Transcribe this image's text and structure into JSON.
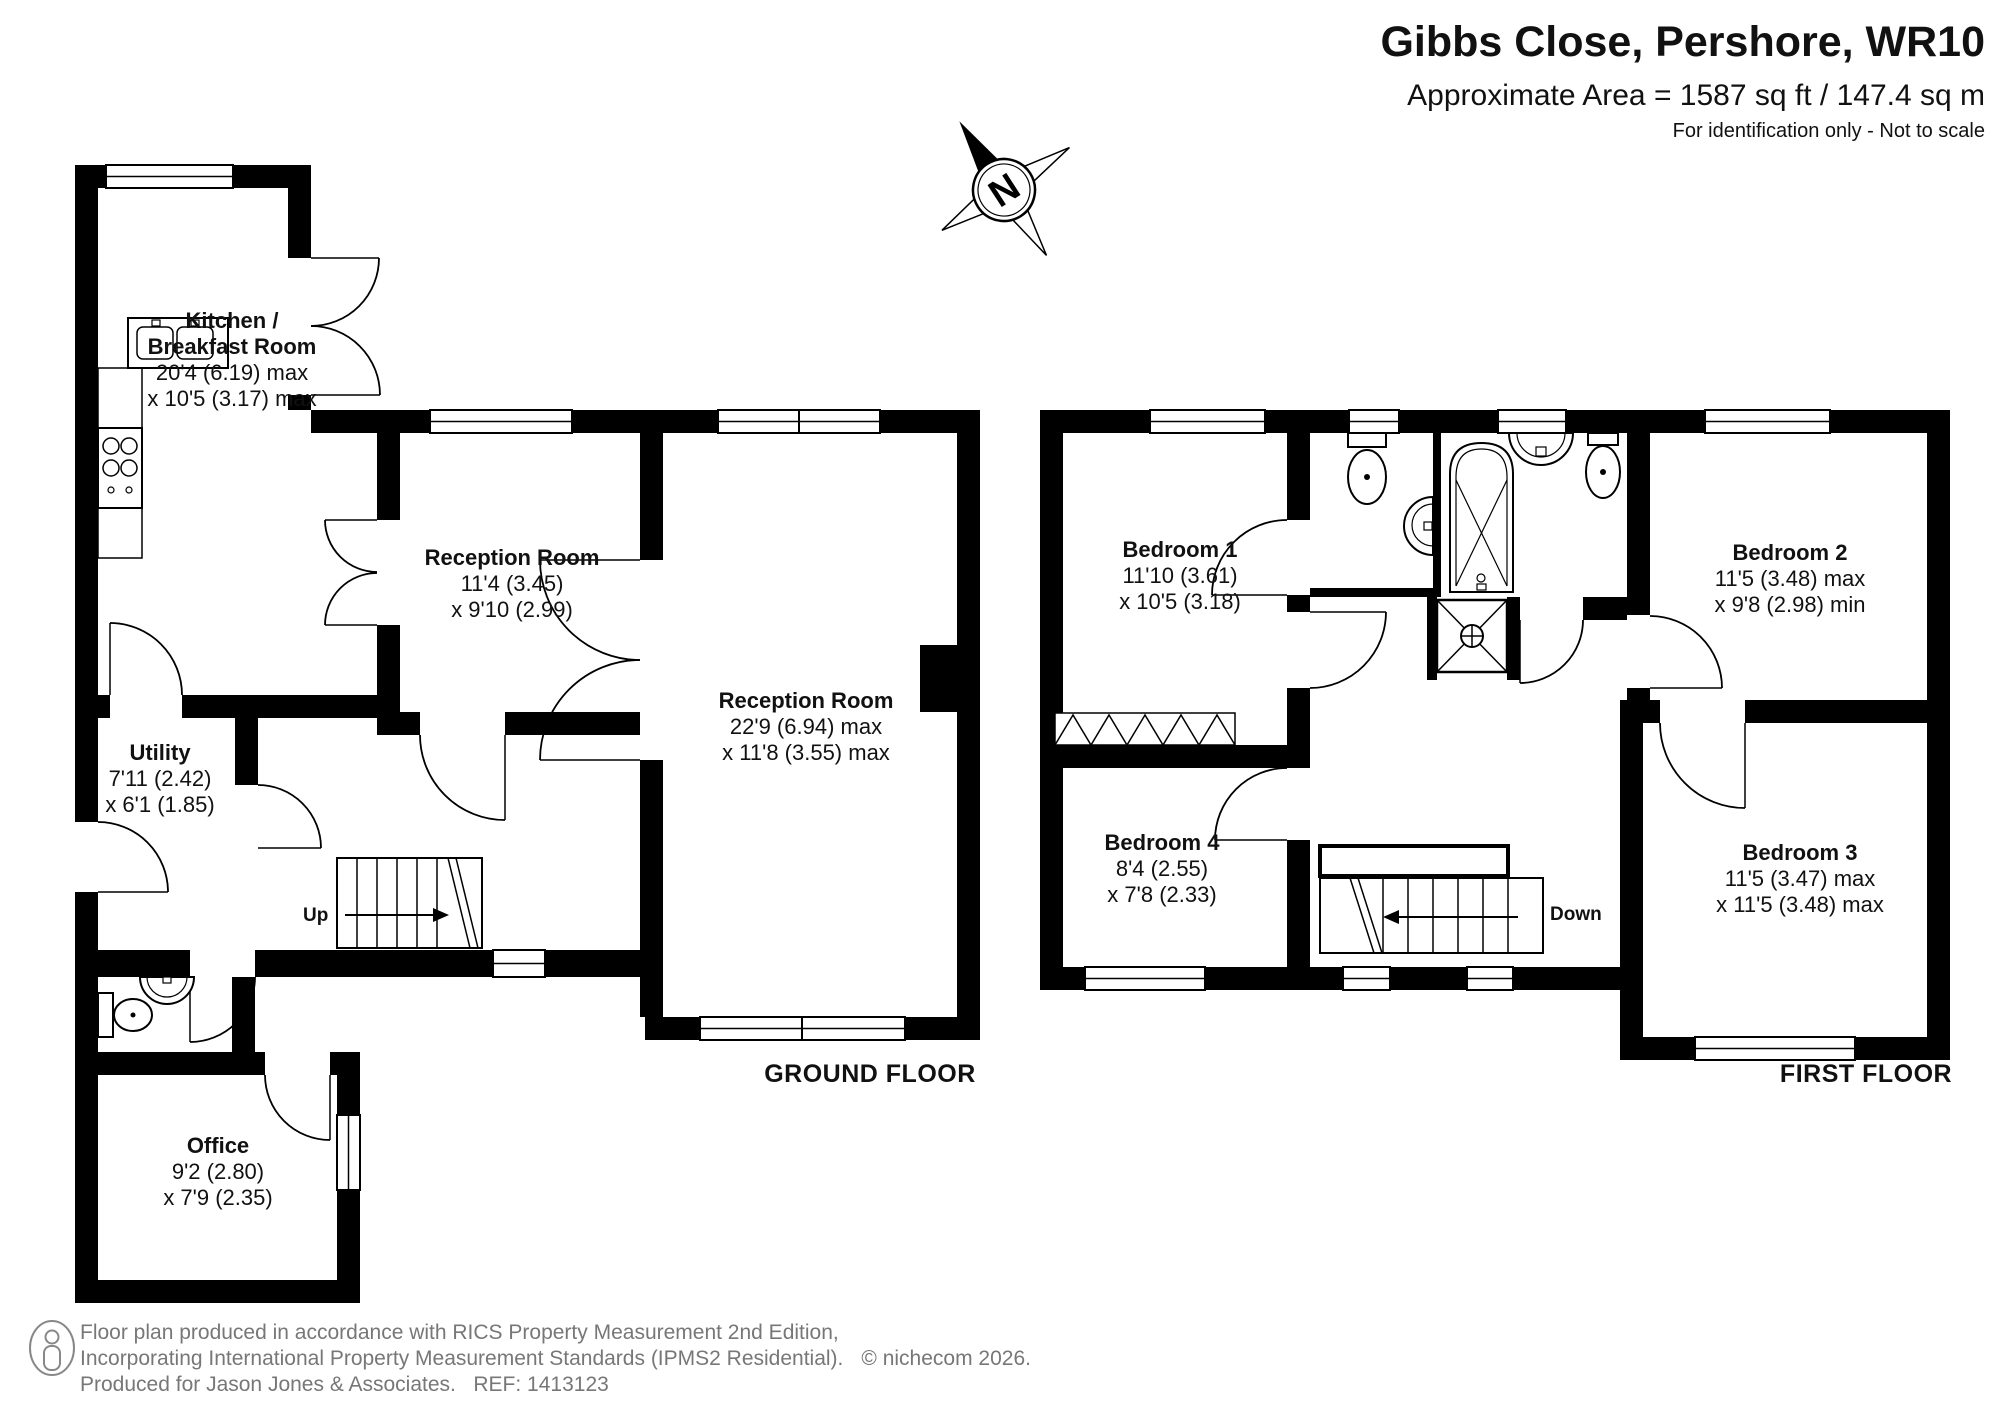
{
  "header": {
    "title": "Gibbs Close, Pershore, WR10",
    "area": "Approximate Area = 1587 sq ft / 147.4 sq m",
    "note": "For identification only - Not to scale"
  },
  "compass": {
    "label": "N"
  },
  "ground_floor": {
    "label": "GROUND FLOOR",
    "stairs_label": "Up",
    "rooms": {
      "kitchen": {
        "name_lines": [
          "Kitchen /",
          "Breakfast Room"
        ],
        "dim_lines": [
          "20'4 (6.19) max",
          "x 10'5 (3.17) max"
        ]
      },
      "reception_room_1": {
        "name_lines": [
          "Reception Room"
        ],
        "dim_lines": [
          "11'4 (3.45)",
          "x 9'10 (2.99)"
        ]
      },
      "reception_room_2": {
        "name_lines": [
          "Reception Room"
        ],
        "dim_lines": [
          "22'9 (6.94) max",
          "x 11'8 (3.55) max"
        ]
      },
      "utility": {
        "name_lines": [
          "Utility"
        ],
        "dim_lines": [
          "7'11 (2.42)",
          "x 6'1 (1.85)"
        ]
      },
      "office": {
        "name_lines": [
          "Office"
        ],
        "dim_lines": [
          "9'2 (2.80)",
          "x 7'9 (2.35)"
        ]
      }
    }
  },
  "first_floor": {
    "label": "FIRST FLOOR",
    "stairs_label": "Down",
    "rooms": {
      "bedroom_1": {
        "name_lines": [
          "Bedroom 1"
        ],
        "dim_lines": [
          "11'10 (3.61)",
          "x 10'5 (3.18)"
        ]
      },
      "bedroom_2": {
        "name_lines": [
          "Bedroom 2"
        ],
        "dim_lines": [
          "11'5 (3.48) max",
          "x 9'8 (2.98) min"
        ]
      },
      "bedroom_3": {
        "name_lines": [
          "Bedroom 3"
        ],
        "dim_lines": [
          "11'5 (3.47) max",
          "x 11'5 (3.48) max"
        ]
      },
      "bedroom_4": {
        "name_lines": [
          "Bedroom 4"
        ],
        "dim_lines": [
          "8'4 (2.55)",
          "x 7'8 (2.33)"
        ]
      }
    }
  },
  "footer": {
    "line1": "Floor plan produced in accordance with RICS Property Measurement 2nd Edition,",
    "line2": "Incorporating International Property Measurement Standards (IPMS2 Residential).",
    "copyright": "© nichecom 2026.",
    "line3": "Produced for Jason Jones & Associates.   REF: 1413123"
  }
}
